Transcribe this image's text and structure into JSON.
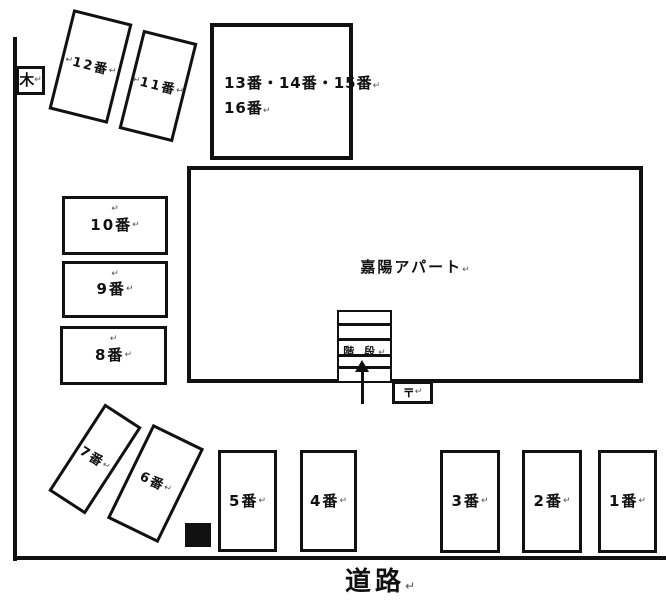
{
  "return_mark": "↵",
  "building": {
    "label": "嘉陽アパート"
  },
  "stairs": {
    "label": "階 段"
  },
  "mailbox": {
    "label": "〒"
  },
  "tree": {
    "label": "木"
  },
  "road": {
    "label": "道路"
  },
  "group_space": {
    "line1": "13番・14番・15番",
    "line2": "16番"
  },
  "spaces": [
    {
      "label": "1番"
    },
    {
      "label": "2番"
    },
    {
      "label": "3番"
    },
    {
      "label": "4番"
    },
    {
      "label": "5番"
    },
    {
      "label": "6番"
    },
    {
      "label": "7番"
    },
    {
      "label": "8番"
    },
    {
      "label": "9番"
    },
    {
      "label": "10番"
    },
    {
      "label": "11番"
    },
    {
      "label": "12番"
    }
  ]
}
